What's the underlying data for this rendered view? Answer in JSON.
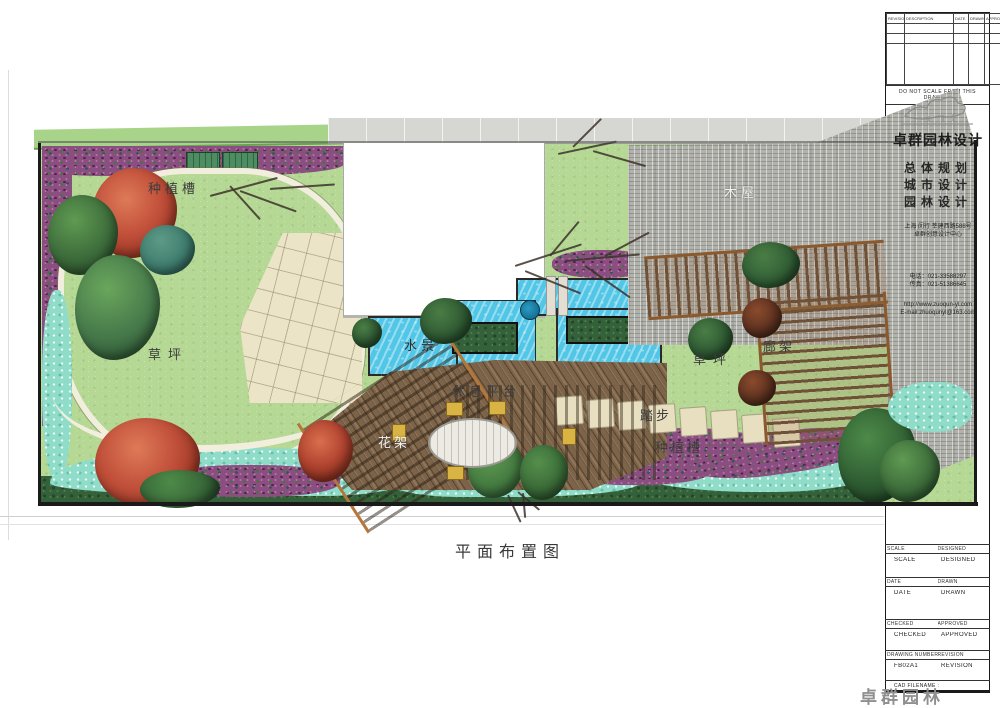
{
  "page": {
    "plan_title": "平面布置图",
    "watermark": "卓群园林"
  },
  "plan": {
    "labels": [
      {
        "id": "planting-trough-left",
        "text": "种植槽"
      },
      {
        "id": "lawn-left",
        "text": "草坪"
      },
      {
        "id": "water-feature",
        "text": "水景"
      },
      {
        "id": "rest-platform",
        "text": "休息平台"
      },
      {
        "id": "flower-trellis",
        "text": "花架"
      },
      {
        "id": "stepping-stones",
        "text": "踏步"
      },
      {
        "id": "planting-trough-right",
        "text": "种植槽"
      },
      {
        "id": "lawn-right",
        "text": "草坪"
      },
      {
        "id": "corridor-pergola",
        "text": "廊架"
      },
      {
        "id": "wood-house",
        "text": "木屋"
      }
    ]
  },
  "title_block": {
    "revision_table": {
      "headers": [
        "REVISION",
        "DESCRIPTION",
        "DATE",
        "DRAWN",
        "APPROVED"
      ]
    },
    "note": "DO NOT SCALE FROM THIS DRAWING",
    "brand": {
      "name": "卓群园林设计",
      "services": [
        "总体规划",
        "城市设计",
        "园林设计"
      ],
      "address_line1": "上海 闵行 莘建西路588号",
      "address_line2": "卓群创意设计中心",
      "phone": "电话：021-33588297",
      "fax": "传真：021-51386645",
      "web": "http://www.zuoqun-yl.com",
      "email": "E-mail:zhuoqunyl@163.com"
    },
    "fields": {
      "scale_label": "SCALE",
      "scale_value": "SCALE",
      "designed_label": "DESIGNED",
      "designed_value": "DESIGNED",
      "date_label": "DATE",
      "date_value": "DATE",
      "drawn_label": "DRAWN",
      "drawn_value": "DRAWN",
      "checked_label": "CHECKED",
      "checked_value": "CHECKED",
      "approved_label": "APPROVED",
      "approved_value": "APPROVED",
      "drawing_number_label": "DRAWING NUMBER",
      "drawing_number_value": "FB02A1",
      "revision_label": "REVISION",
      "revision_value": "REVISION",
      "cad_note": "CAD FILENAME :"
    }
  },
  "colors": {
    "lawn_green": "#b5d894",
    "water_blue": "#52c6e6",
    "roof_gray": "#b2b2ac",
    "flower_purple": "#8a4f80",
    "pebble_teal": "#8fdcc9",
    "deck_wood": "#7d6347",
    "paving_beige": "#ece4c6",
    "maple_red": "#c1503a",
    "tree_green": "#3c6b3a"
  }
}
